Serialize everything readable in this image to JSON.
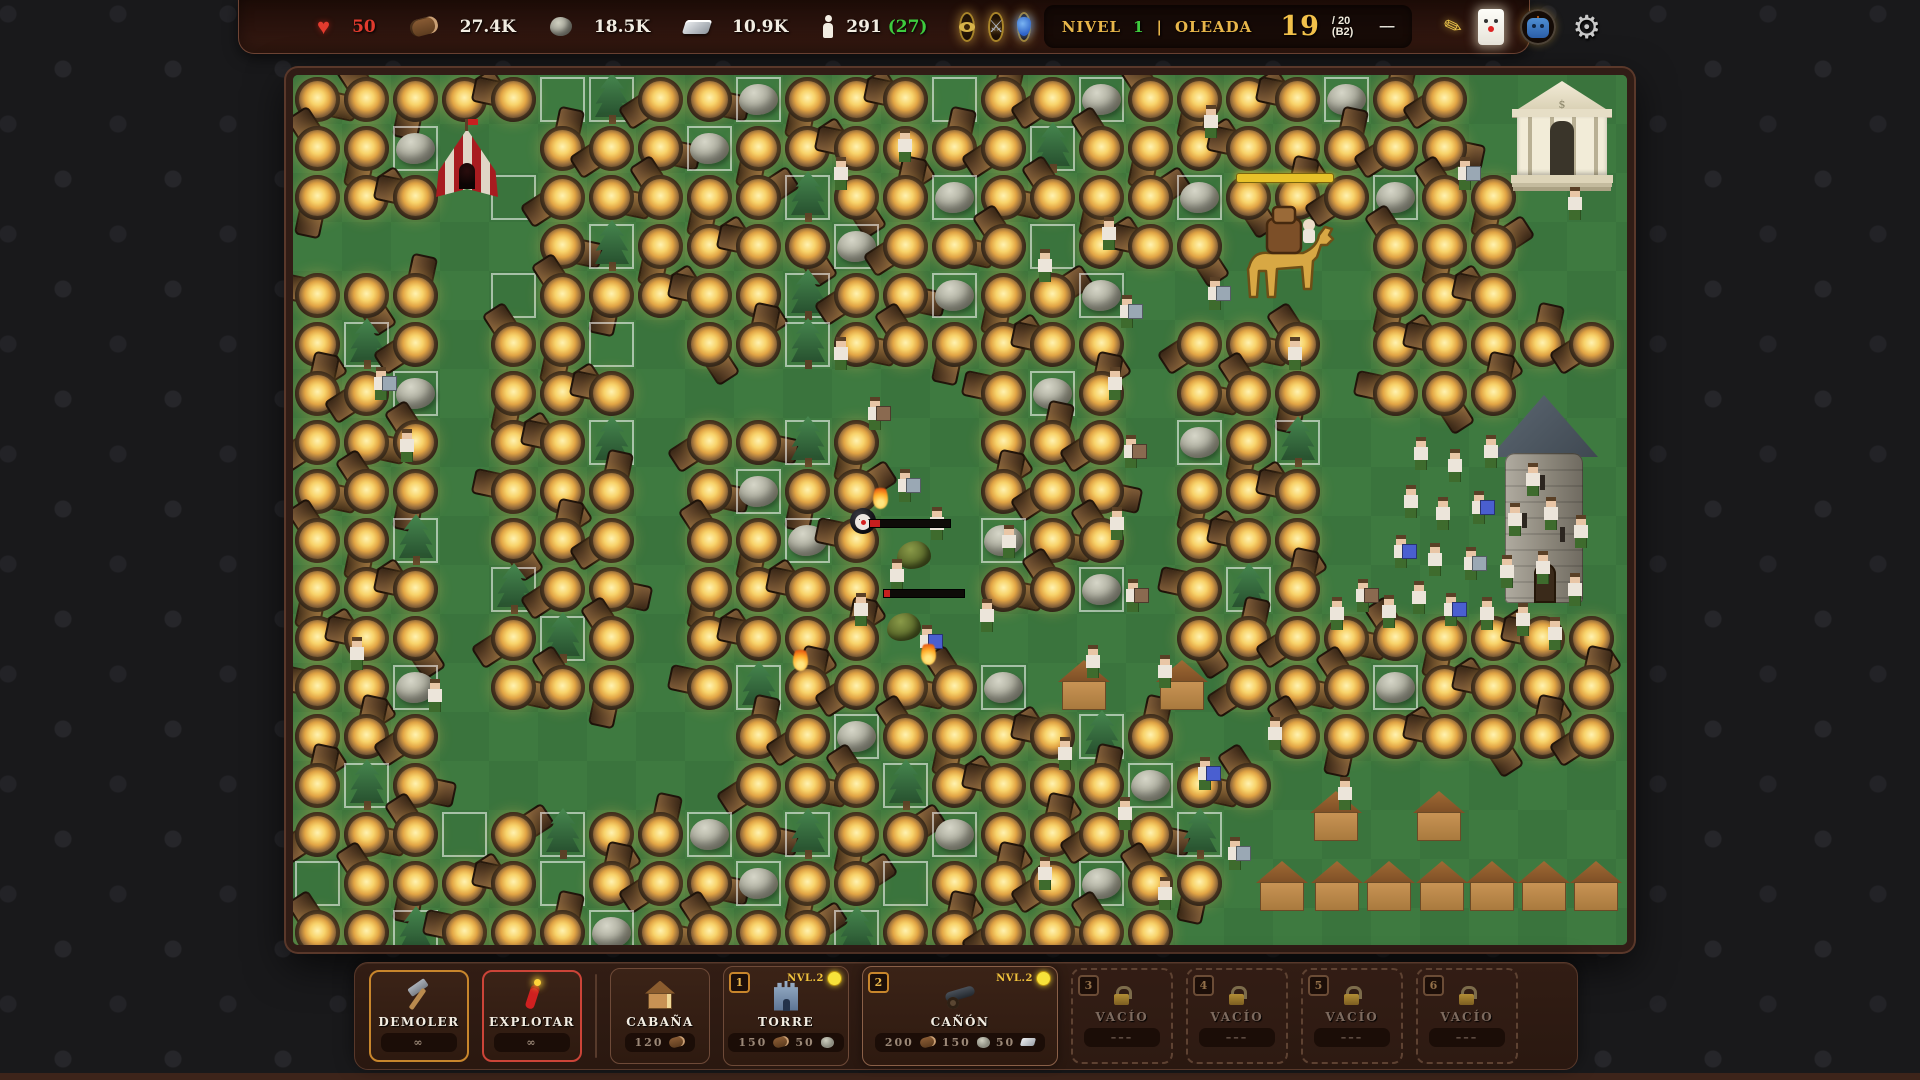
{
  "hud": {
    "health": {
      "icon": "heart",
      "value": "50"
    },
    "resources": [
      {
        "icon": "wood-log",
        "value": "27.4K"
      },
      {
        "icon": "stone",
        "value": "18.5K"
      },
      {
        "icon": "metal-ingot",
        "value": "10.9K"
      }
    ],
    "population": {
      "icon": "person",
      "value": "291",
      "bonus": "(27)"
    },
    "buffs": [
      {
        "icon": "eye"
      },
      {
        "icon": "crossed-swords"
      },
      {
        "icon": "potion-urn"
      }
    ],
    "wave": {
      "level_label": "NIVEL",
      "level_value": "1",
      "separator": "|",
      "wave_label": "OLEADA",
      "current": "19",
      "total": "/ 20",
      "batch": "(B2)",
      "skip_icon": "––"
    },
    "actions": [
      {
        "icon": "quill"
      },
      {
        "icon": "clown-card"
      },
      {
        "icon": "robot-head"
      },
      {
        "icon": "gear"
      }
    ],
    "colors": {
      "accent_gold": "#e8b64a",
      "health_red": "#e23b2e",
      "bonus_green": "#3ecb3e"
    }
  },
  "toolbar": {
    "tools": [
      {
        "id": "demoler",
        "label": "DEMOLER",
        "cost": "∞",
        "icon": "hammer"
      },
      {
        "id": "explotar",
        "label": "EXPLOTAR",
        "cost": "∞",
        "icon": "dynamite"
      }
    ],
    "buildings": [
      {
        "id": "cabana",
        "label": "CABAÑA",
        "icon": "cabin",
        "costs": [
          {
            "value": "120",
            "icon": "wood-log"
          }
        ]
      },
      {
        "id": "torre",
        "label": "TORRE",
        "hotkey": "1",
        "level": "NVL.2",
        "icon": "castle-tower",
        "costs": [
          {
            "value": "150",
            "icon": "wood-log"
          },
          {
            "value": "50",
            "icon": "stone"
          }
        ]
      },
      {
        "id": "canon",
        "label": "CAÑÓN",
        "hotkey": "2",
        "level": "NVL.2",
        "selected": true,
        "icon": "cannon",
        "costs": [
          {
            "value": "200",
            "icon": "wood-log"
          },
          {
            "value": "150",
            "icon": "stone"
          },
          {
            "value": "50",
            "icon": "metal-ingot"
          }
        ]
      }
    ],
    "locked": [
      {
        "hotkey": "3",
        "label": "VACÍO",
        "cost": "–––"
      },
      {
        "hotkey": "4",
        "label": "VACÍO",
        "cost": "–––"
      },
      {
        "hotkey": "5",
        "label": "VACÍO",
        "cost": "–––"
      },
      {
        "hotkey": "6",
        "label": "VACÍO",
        "cost": "–––"
      }
    ]
  },
  "map": {
    "cols": 27,
    "rows": 18,
    "cell": 49,
    "colors": {
      "grass": "#3f7b41",
      "grass_alt": "#3a743d",
      "path_fill": "#4a332b",
      "path_edge": "#70523f",
      "outline": "rgba(255,255,255,0.55)"
    },
    "path": {
      "d": "M -14 165 H 140 Q 168 165 168 193 V 646 Q 168 674 196 674 H 352 Q 380 674 380 646 V 328 Q 380 300 408 300 H 600 Q 628 300 628 328 V 525 Q 628 553 656 553 H 808 Q 836 553 836 525 V 248 Q 836 220 864 220 H 1010 Q 1038 220 1038 248 V 478 Q 1038 506 1066 506 H 1292"
    },
    "grid": [
      "CCCCCOTCCRCCCOCCRCCCCRCC...",
      "CCR..CCCRCCCCCCTCCCCCCCC...",
      "CCC.OCCCCCTCCRCCCCRCCCRCC..",
      "xxxxxCTCCCCRCCCOCCC...CCC..",
      "CCCxOCCCCCTCCRCCRxxxxxCCC..",
      "CTCxCCOxCCTCCCCCCxCCCxCCCCC",
      "CCRxCCCxxxxxxxCRCxCCCxCCC..",
      "CCCxCCTxCCTCxxCCCxRCTx.....",
      "CCCxCCCxCRCCxxCCCxCCCx.....",
      "CCTxCCCxCCRCxxRCCxCCCx.....",
      "CCCxTCCxCCCCxxCCRxCTCxxxx..",
      "CCCxCTCxCCCCxxxxxxCCCCCCCCC",
      "CCRxCCCxCTCCCCR....CCCRCCCC",
      "CCCxxxxxxCCRCCCCTC..CCCCCCC",
      "CTCxxxxxxCCCTCCCCRCC.......",
      "CCCOCTCCRCTCCRCCCCT........",
      "OCCCCOCCCRCCOCCCRCC........",
      "CCTCCCRCCCCTCCCCCC........."
    ],
    "props": [
      {
        "t": "tent",
        "x": 143,
        "y": 48
      },
      {
        "t": "temple",
        "x": 1222,
        "y": 6
      },
      {
        "t": "tower",
        "x": 1203,
        "y": 320
      },
      {
        "t": "camel",
        "x": 936,
        "y": 130
      },
      {
        "t": "ybar",
        "x": 943,
        "y": 98,
        "w": 96
      },
      {
        "t": "hut",
        "x": 765,
        "y": 585
      },
      {
        "t": "hut",
        "x": 863,
        "y": 585
      },
      {
        "t": "hut",
        "x": 1017,
        "y": 716
      },
      {
        "t": "hut",
        "x": 1120,
        "y": 716
      },
      {
        "t": "hut",
        "x": 963,
        "y": 786
      },
      {
        "t": "hut",
        "x": 1018,
        "y": 786
      },
      {
        "t": "hut",
        "x": 1070,
        "y": 786
      },
      {
        "t": "hut",
        "x": 1123,
        "y": 786
      },
      {
        "t": "hut",
        "x": 1173,
        "y": 786
      },
      {
        "t": "hut",
        "x": 1225,
        "y": 786
      },
      {
        "t": "hut",
        "x": 1277,
        "y": 786
      },
      {
        "t": "bomb",
        "x": 557,
        "y": 433
      },
      {
        "t": "blob",
        "x": 604,
        "y": 466
      },
      {
        "t": "blob",
        "x": 594,
        "y": 538
      },
      {
        "t": "hpbar",
        "x": 576,
        "y": 444,
        "w": 80,
        "f": 12
      },
      {
        "t": "hpbar",
        "x": 590,
        "y": 514,
        "w": 80,
        "f": 8
      },
      {
        "t": "flame",
        "x": 500,
        "y": 572
      },
      {
        "t": "flame",
        "x": 628,
        "y": 566
      },
      {
        "t": "flame",
        "x": 580,
        "y": 410
      }
    ],
    "villagers": [
      [
        1128,
        392
      ],
      [
        1162,
        404
      ],
      [
        1198,
        390
      ],
      [
        1240,
        418
      ],
      [
        1118,
        440
      ],
      [
        1150,
        452
      ],
      [
        1186,
        446,
        "blue"
      ],
      [
        1222,
        458
      ],
      [
        1258,
        452
      ],
      [
        1288,
        470
      ],
      [
        1108,
        490,
        "blue"
      ],
      [
        1142,
        498
      ],
      [
        1178,
        502,
        "gray"
      ],
      [
        1214,
        510
      ],
      [
        1250,
        506
      ],
      [
        1282,
        528
      ],
      [
        1126,
        536
      ],
      [
        1158,
        548,
        "blue"
      ],
      [
        1194,
        552
      ],
      [
        1230,
        558
      ],
      [
        1262,
        572
      ],
      [
        1096,
        550
      ],
      [
        1070,
        534,
        "brown"
      ],
      [
        1044,
        552
      ],
      [
        816,
        172
      ],
      [
        834,
        250,
        "gray"
      ],
      [
        822,
        322
      ],
      [
        838,
        390,
        "brown"
      ],
      [
        824,
        462
      ],
      [
        840,
        534,
        "brown"
      ],
      [
        548,
        292
      ],
      [
        582,
        352,
        "brown"
      ],
      [
        612,
        424,
        "gray"
      ],
      [
        644,
        462
      ],
      [
        604,
        514
      ],
      [
        568,
        548
      ],
      [
        634,
        580,
        "blue"
      ],
      [
        694,
        554
      ],
      [
        716,
        480
      ],
      [
        88,
        322,
        "gray"
      ],
      [
        114,
        384
      ],
      [
        64,
        592
      ],
      [
        142,
        634
      ],
      [
        548,
        112
      ],
      [
        752,
        204
      ],
      [
        612,
        84
      ],
      [
        918,
        60
      ],
      [
        922,
        232,
        "gray"
      ],
      [
        1002,
        292
      ],
      [
        1172,
        112,
        "gray"
      ],
      [
        1282,
        142
      ],
      [
        772,
        692
      ],
      [
        832,
        752
      ],
      [
        912,
        712,
        "blue"
      ],
      [
        982,
        672
      ],
      [
        1052,
        732
      ],
      [
        752,
        812
      ],
      [
        872,
        832
      ],
      [
        942,
        792,
        "gray"
      ],
      [
        800,
        600
      ],
      [
        872,
        610
      ]
    ]
  }
}
